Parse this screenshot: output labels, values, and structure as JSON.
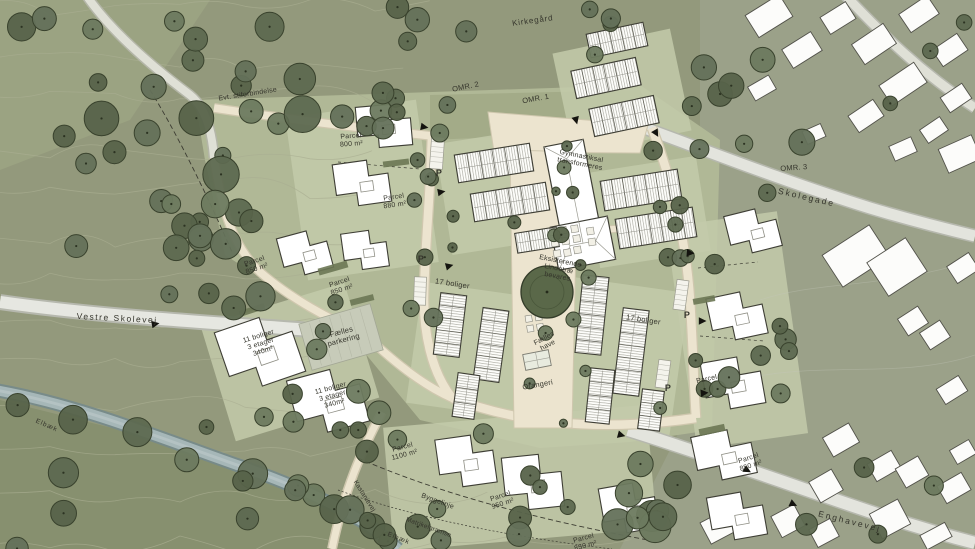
{
  "map": {
    "type": "architectural-site-plan",
    "palette": {
      "terrain": "#93997c",
      "terrain_dark": "#87906f",
      "town_background": "#9ba189",
      "development_green": "#b2ba98",
      "block_green": "#c3caaa",
      "road_cream": "#ece4cf",
      "road_grey": "#e6e7e1",
      "stream_blue": "#a6b7b8",
      "tree_green": "#5d6950",
      "tree_outline": "#39422d",
      "building_white": "#ffffff",
      "outline_dark": "#3e3e35",
      "label_text": "#35352c"
    },
    "labels": [
      {
        "id": "kirkegaard",
        "text": "Kirkegård",
        "x": 533,
        "y": 23,
        "rot": -8,
        "size": 8,
        "ls": 0.8
      },
      {
        "id": "sti",
        "text": "Evt. stiforbindelse",
        "x": 248,
        "y": 96,
        "rot": -9,
        "size": 7
      },
      {
        "id": "omr2",
        "text": "OMR. 2",
        "x": 466,
        "y": 89,
        "rot": -12,
        "size": 7.5
      },
      {
        "id": "omr1",
        "text": "OMR. 1",
        "x": 536,
        "y": 101,
        "rot": -10,
        "size": 7.5
      },
      {
        "id": "omr3",
        "text": "OMR. 3",
        "x": 794,
        "y": 170,
        "rot": -4,
        "size": 7.5
      },
      {
        "id": "skolegade",
        "text": "Skolegade",
        "x": 806,
        "y": 200,
        "rot": 13,
        "size": 8.5,
        "ls": 2
      },
      {
        "id": "parcel-800",
        "text": "Parcel\n800 m²",
        "x": 351,
        "y": 138,
        "rot": -4,
        "size": 7
      },
      {
        "id": "parcel-880",
        "text": "Parcel\n880 m²",
        "x": 394,
        "y": 199,
        "rot": -8,
        "size": 7
      },
      {
        "id": "parcel-850-a",
        "text": "Parcel\n850 m²",
        "x": 255,
        "y": 263,
        "rot": -18,
        "size": 7
      },
      {
        "id": "parcel-850-b",
        "text": "Parcel\n850 m²",
        "x": 340,
        "y": 284,
        "rot": -18,
        "size": 7
      },
      {
        "id": "gym",
        "text": "Gymnastiksal\ntransformeres",
        "x": 581,
        "y": 158,
        "rot": 11,
        "size": 7
      },
      {
        "id": "lindetrae",
        "text": "Eksisterende\nLindetræ\nbevares",
        "x": 560,
        "y": 263,
        "rot": 11,
        "size": 7
      },
      {
        "id": "boliger17-a",
        "text": "17 boliger",
        "x": 452,
        "y": 286,
        "rot": 9,
        "size": 7.5
      },
      {
        "id": "boliger17-b",
        "text": "17 boliger",
        "x": 643,
        "y": 322,
        "rot": 9,
        "size": 7.5
      },
      {
        "id": "boliger11-a",
        "text": "11 boliger\n3 etager\n340m²",
        "x": 259,
        "y": 338,
        "rot": -17,
        "size": 7
      },
      {
        "id": "parkering",
        "text": "Fælles\nparkering",
        "x": 342,
        "y": 334,
        "rot": -15,
        "size": 7.5
      },
      {
        "id": "boliger11-b",
        "text": "11 boliger\n3 etager\n340m²",
        "x": 331,
        "y": 390,
        "rot": -15,
        "size": 7
      },
      {
        "id": "faelles-have",
        "text": "Fælles\nhave",
        "x": 545,
        "y": 340,
        "rot": -28,
        "size": 7
      },
      {
        "id": "orangeri",
        "text": "Orangeri",
        "x": 538,
        "y": 387,
        "rot": -10,
        "size": 7.5
      },
      {
        "id": "vestre-skolevej",
        "text": "Vestre Skolevej",
        "x": 117,
        "y": 321,
        "rot": 3,
        "size": 8.5,
        "ls": 1.5
      },
      {
        "id": "p1",
        "text": "P",
        "x": 439,
        "y": 176,
        "rot": 0,
        "size": 9,
        "w": 700
      },
      {
        "id": "p2",
        "text": "P",
        "x": 421,
        "y": 262,
        "rot": 0,
        "size": 9,
        "w": 700
      },
      {
        "id": "p3",
        "text": "P",
        "x": 687,
        "y": 318,
        "rot": 0,
        "size": 9,
        "w": 700
      },
      {
        "id": "p4",
        "text": "P",
        "x": 668,
        "y": 391,
        "rot": 0,
        "size": 9,
        "w": 700
      },
      {
        "id": "byggelinje",
        "text": "Byggelinje",
        "x": 437,
        "y": 503,
        "rot": 20,
        "size": 7
      },
      {
        "id": "matrikelgraense",
        "text": "Matrikelgrænse",
        "x": 428,
        "y": 529,
        "rot": 20,
        "size": 6.5
      },
      {
        "id": "elbaek-syd",
        "text": "Elbæk",
        "x": 398,
        "y": 540,
        "rot": 22,
        "size": 6.5,
        "ls": 1
      },
      {
        "id": "elbaek-vest",
        "text": "Elbæk",
        "x": 46,
        "y": 427,
        "rot": 24,
        "size": 6.5,
        "ls": 1
      },
      {
        "id": "kastanievej",
        "text": "Kastanievej",
        "x": 363,
        "y": 497,
        "rot": 58,
        "size": 6.5
      },
      {
        "id": "enghavevej",
        "text": "Enghavevej",
        "x": 849,
        "y": 524,
        "rot": 14,
        "size": 8.5,
        "ls": 2
      },
      {
        "id": "parcel-850-c",
        "text": "Parcel\n850 m²",
        "x": 749,
        "y": 460,
        "rot": -18,
        "size": 7
      },
      {
        "id": "parcel-950",
        "text": "Parcel\n950 m²",
        "x": 501,
        "y": 498,
        "rot": -18,
        "size": 7
      },
      {
        "id": "parcel-1100",
        "text": "Parcel\n1100 m²",
        "x": 403,
        "y": 449,
        "rot": -15,
        "size": 7
      },
      {
        "id": "parcel-850-d",
        "text": "Parcel\n850 m²",
        "x": 584,
        "y": 540,
        "rot": -15,
        "size": 7
      },
      {
        "id": "parcel-e",
        "text": "Parcel",
        "x": 707,
        "y": 381,
        "rot": -12,
        "size": 7
      }
    ]
  }
}
